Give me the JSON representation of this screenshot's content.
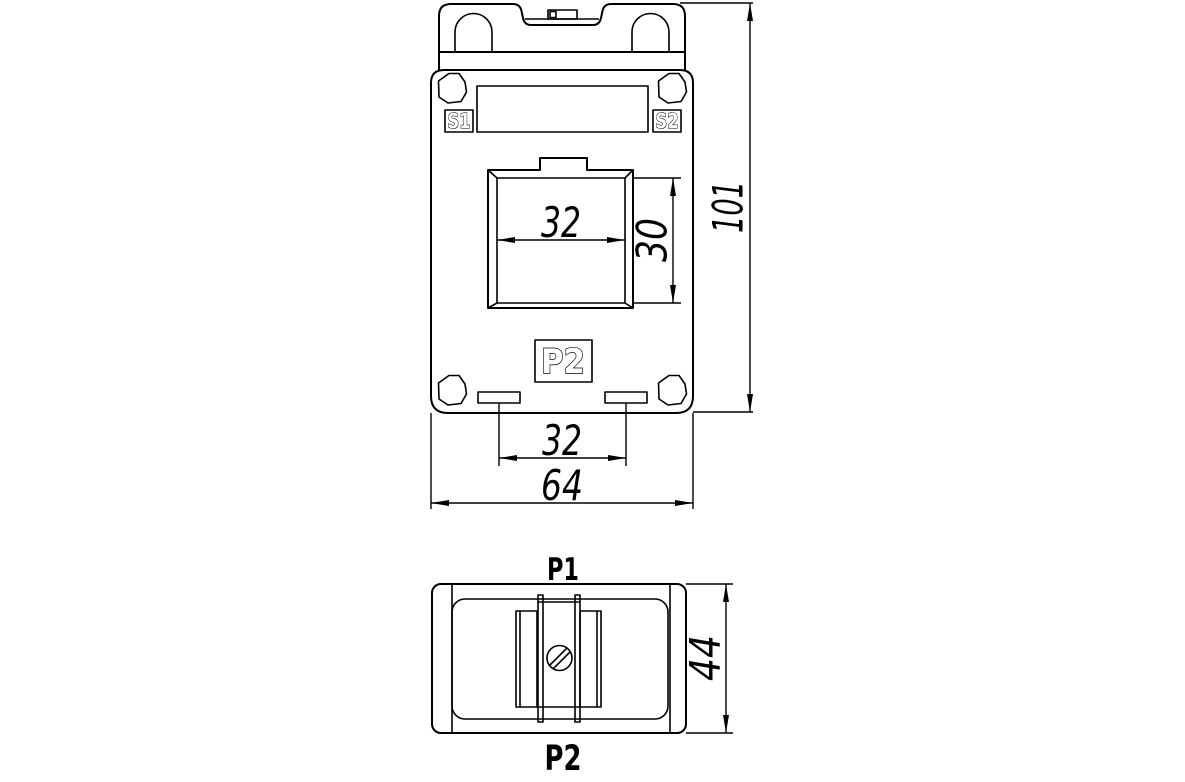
{
  "front_view": {
    "label_s1": "S1",
    "label_s2": "S2",
    "label_p2": "P2",
    "dim_window_width": "32",
    "dim_window_height": "30",
    "dim_slot_spacing": "32",
    "dim_overall_width": "64",
    "dim_overall_height": "101"
  },
  "top_view": {
    "label_p1": "P1",
    "label_p2": "P2",
    "dim_depth": "44"
  },
  "colors": {
    "line": "#000000",
    "background": "#ffffff"
  }
}
